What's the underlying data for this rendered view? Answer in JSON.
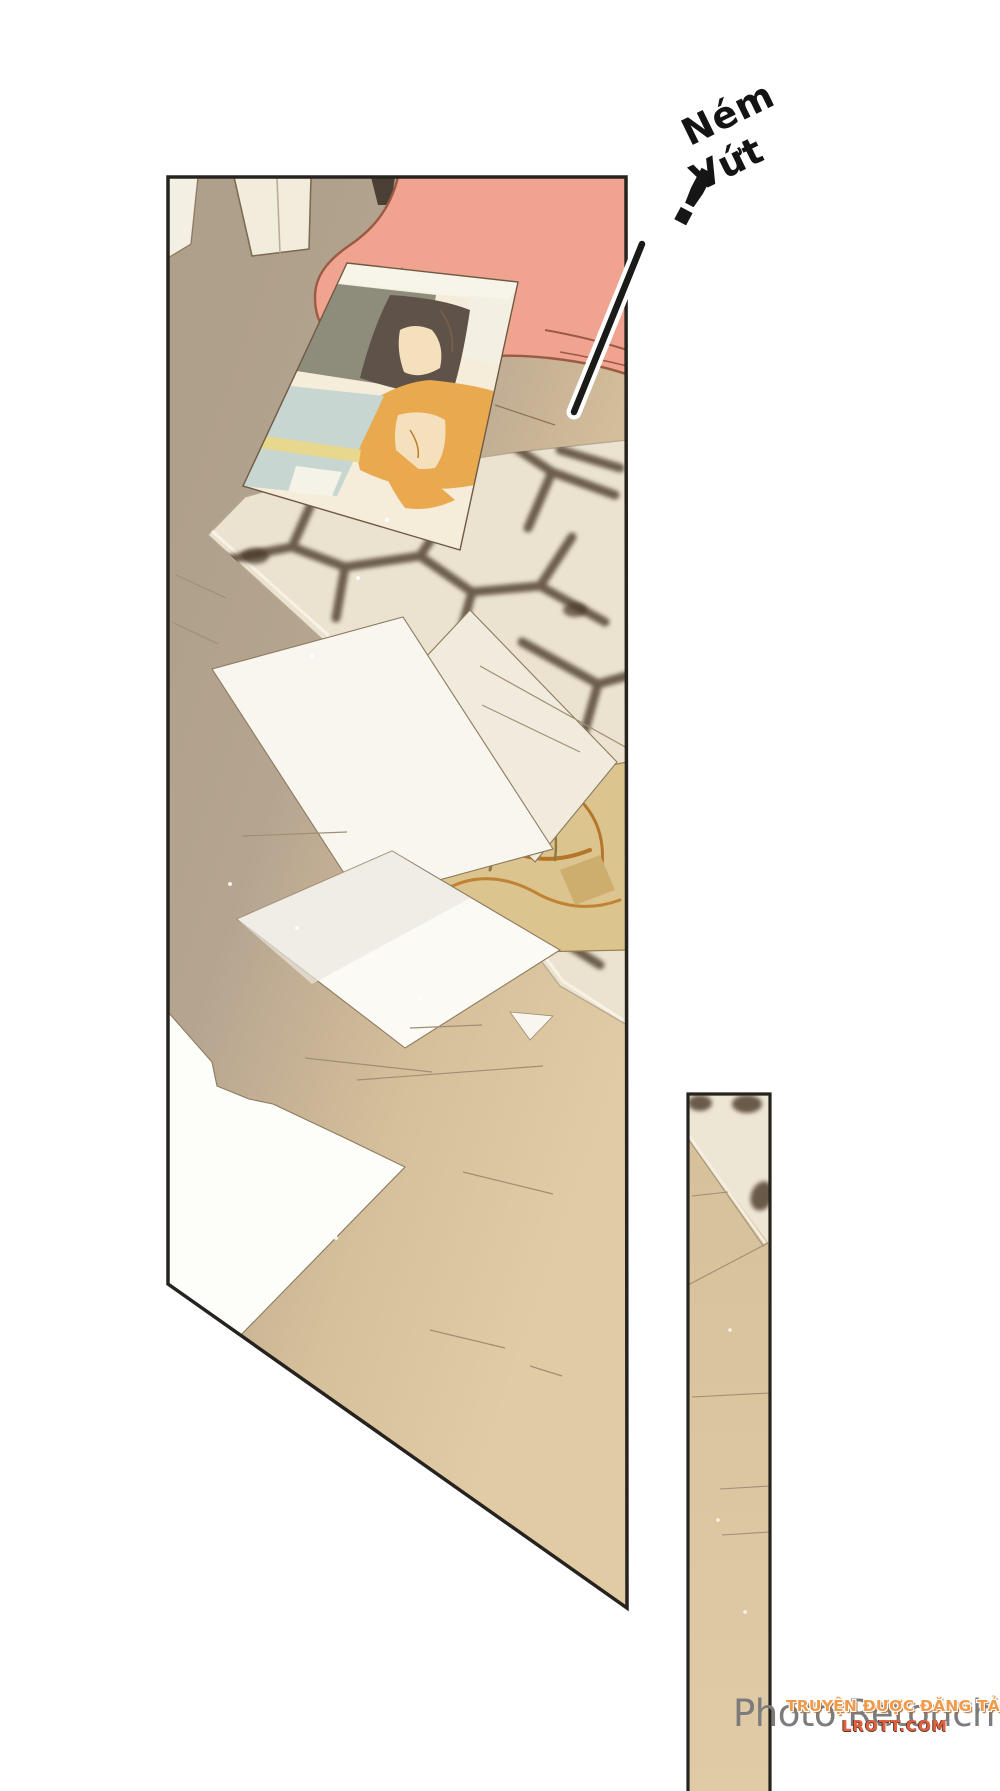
{
  "page": {
    "type": "comic-page",
    "background_color": "#ffffff"
  },
  "sfx": {
    "line1": "Ném",
    "line2": "Vứt",
    "exclamation": "!"
  },
  "watermarks": {
    "photo_retouch": "Photo Retouch",
    "site_banner": "TRUYỆN ĐƯỢC ĐĂNG TẢI TẠI",
    "site_url": "LROTT.COM"
  },
  "colors": {
    "panel_border": "#26231f",
    "floor_taupe": "#b2a28e",
    "floor_tan": "#d8c29c",
    "couch_pink": "#f0a38f",
    "couch_outline": "#9b5a43",
    "rug_cream": "#ebe3d0",
    "shadow_brown": "#4a3827",
    "paper_white": "#f8f6ef",
    "photo_hair_orange": "#e9a94f",
    "photo_hair_dark": "#5f5248",
    "photo_blanket_blue": "#c7d6d0",
    "watermark_gray": "#7c7c7c",
    "watermark_orange": "#f09a4c",
    "watermark_red": "#e2613c"
  }
}
